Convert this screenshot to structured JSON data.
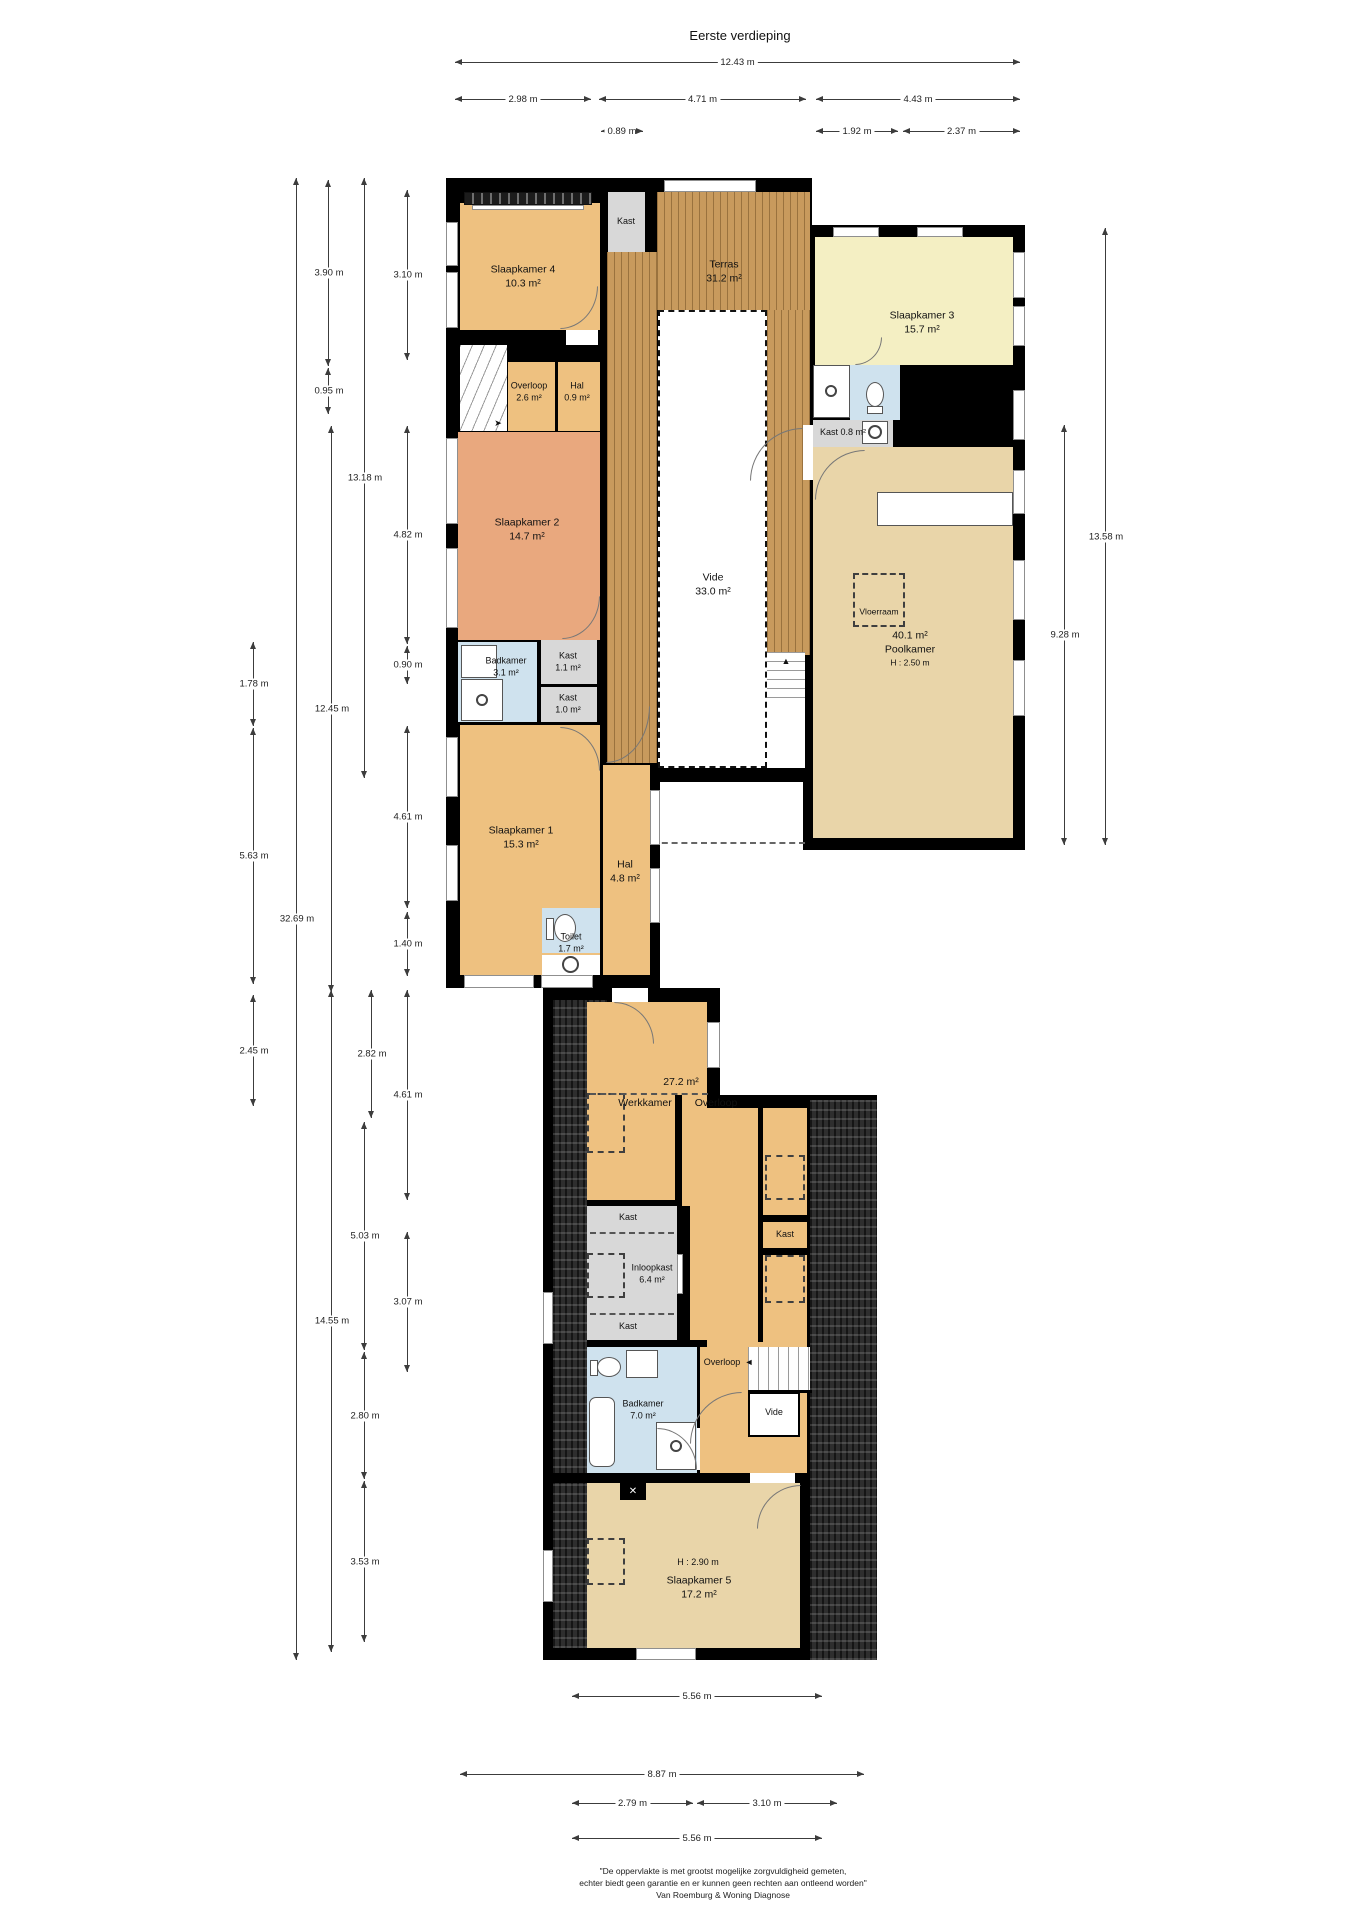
{
  "title": "Eerste verdieping",
  "rooms": {
    "sk4": {
      "name": "Slaapkamer 4",
      "area": "10.3 m²"
    },
    "kast_top": {
      "name": "Kast"
    },
    "terras": {
      "name": "Terras",
      "area": "31.2 m²"
    },
    "sk3": {
      "name": "Slaapkamer 3",
      "area": "15.7 m²"
    },
    "bk21": {
      "name": "Badkamer",
      "area": "2.1 m²"
    },
    "kast08": {
      "name": "Kast",
      "area": "0.8 m²"
    },
    "overloop26": {
      "name": "Overloop",
      "area": "2.6 m²"
    },
    "hal09": {
      "name": "Hal",
      "area": "0.9 m²"
    },
    "sk2": {
      "name": "Slaapkamer 2",
      "area": "14.7 m²"
    },
    "bk31": {
      "name": "Badkamer",
      "area": "3.1 m²"
    },
    "kast11": {
      "name": "Kast",
      "area": "1.1 m²"
    },
    "kast10": {
      "name": "Kast",
      "area": "1.0 m²"
    },
    "vide": {
      "name": "Vide",
      "area": "33.0 m²"
    },
    "poolkamer": {
      "area": "40.1 m²",
      "name": "Poolkamer",
      "height": "H : 2.50 m"
    },
    "vloerraam": {
      "name": "Vloerraam"
    },
    "sk1": {
      "name": "Slaapkamer 1",
      "area": "15.3 m²"
    },
    "hal48": {
      "name": "Hal",
      "area": "4.8 m²"
    },
    "toilet": {
      "name": "Toilet",
      "area": "1.7 m²"
    },
    "werk": {
      "name": "Werkkamer",
      "area": "27.2 m²"
    },
    "overloop_main": {
      "name": "Overloop"
    },
    "kast_a": {
      "name": "Kast"
    },
    "inloopkast": {
      "name": "Inloopkast",
      "area": "6.4 m²"
    },
    "kast_b": {
      "name": "Kast"
    },
    "kast_c": {
      "name": "Kast"
    },
    "bk70": {
      "name": "Badkamer",
      "area": "7.0 m²"
    },
    "overloop_small": {
      "name": "Overloop"
    },
    "vide_small": {
      "name": "Vide"
    },
    "sk5": {
      "name": "Slaapkamer 5",
      "area": "17.2 m²",
      "height": "H : 2.90 m"
    }
  },
  "dims": {
    "top": [
      "12.43 m",
      "2.98 m",
      "4.71 m",
      "4.43 m",
      "0.89 m",
      "1.92 m",
      "2.37 m"
    ],
    "left": [
      "3.90 m",
      "3.10 m",
      "0.95 m",
      "13.18 m",
      "4.82 m",
      "0.90 m",
      "1.78 m",
      "12.45 m",
      "5.63 m",
      "4.61 m",
      "32.69 m",
      "1.40 m",
      "2.45 m",
      "2.82 m",
      "4.61 m",
      "5.03 m",
      "3.07 m",
      "14.55 m",
      "2.80 m",
      "3.53 m"
    ],
    "right": [
      "13.58 m",
      "9.28 m"
    ],
    "bottom": [
      "5.56 m",
      "8.87 m",
      "2.79 m",
      "3.10 m",
      "5.56 m"
    ]
  },
  "icons": {
    "arrow_left": "◄",
    "stairs_up_arrow": "▲",
    "stairs_turn_arrow": "➤",
    "skylight_cross": "✕"
  },
  "footer": {
    "line1": "\"De oppervlakte is met grootst mogelijke zorgvuldigheid gemeten,",
    "line2": "echter biedt geen garantie en er kunnen geen rechten aan ontleend worden\"",
    "line3": "Van Roemburg & Woning Diagnose"
  },
  "colors": {
    "wall": "#000000",
    "room_orange": "#eec180",
    "room_salmon": "#e9a87e",
    "room_yellow": "#f4efc3",
    "room_tan": "#e9d5a9",
    "room_blue": "#cfe2ee",
    "closet_gray": "#d8d8d8",
    "terrace_wood": "#c89a5d",
    "roof_dark": "#2e2e2e"
  }
}
